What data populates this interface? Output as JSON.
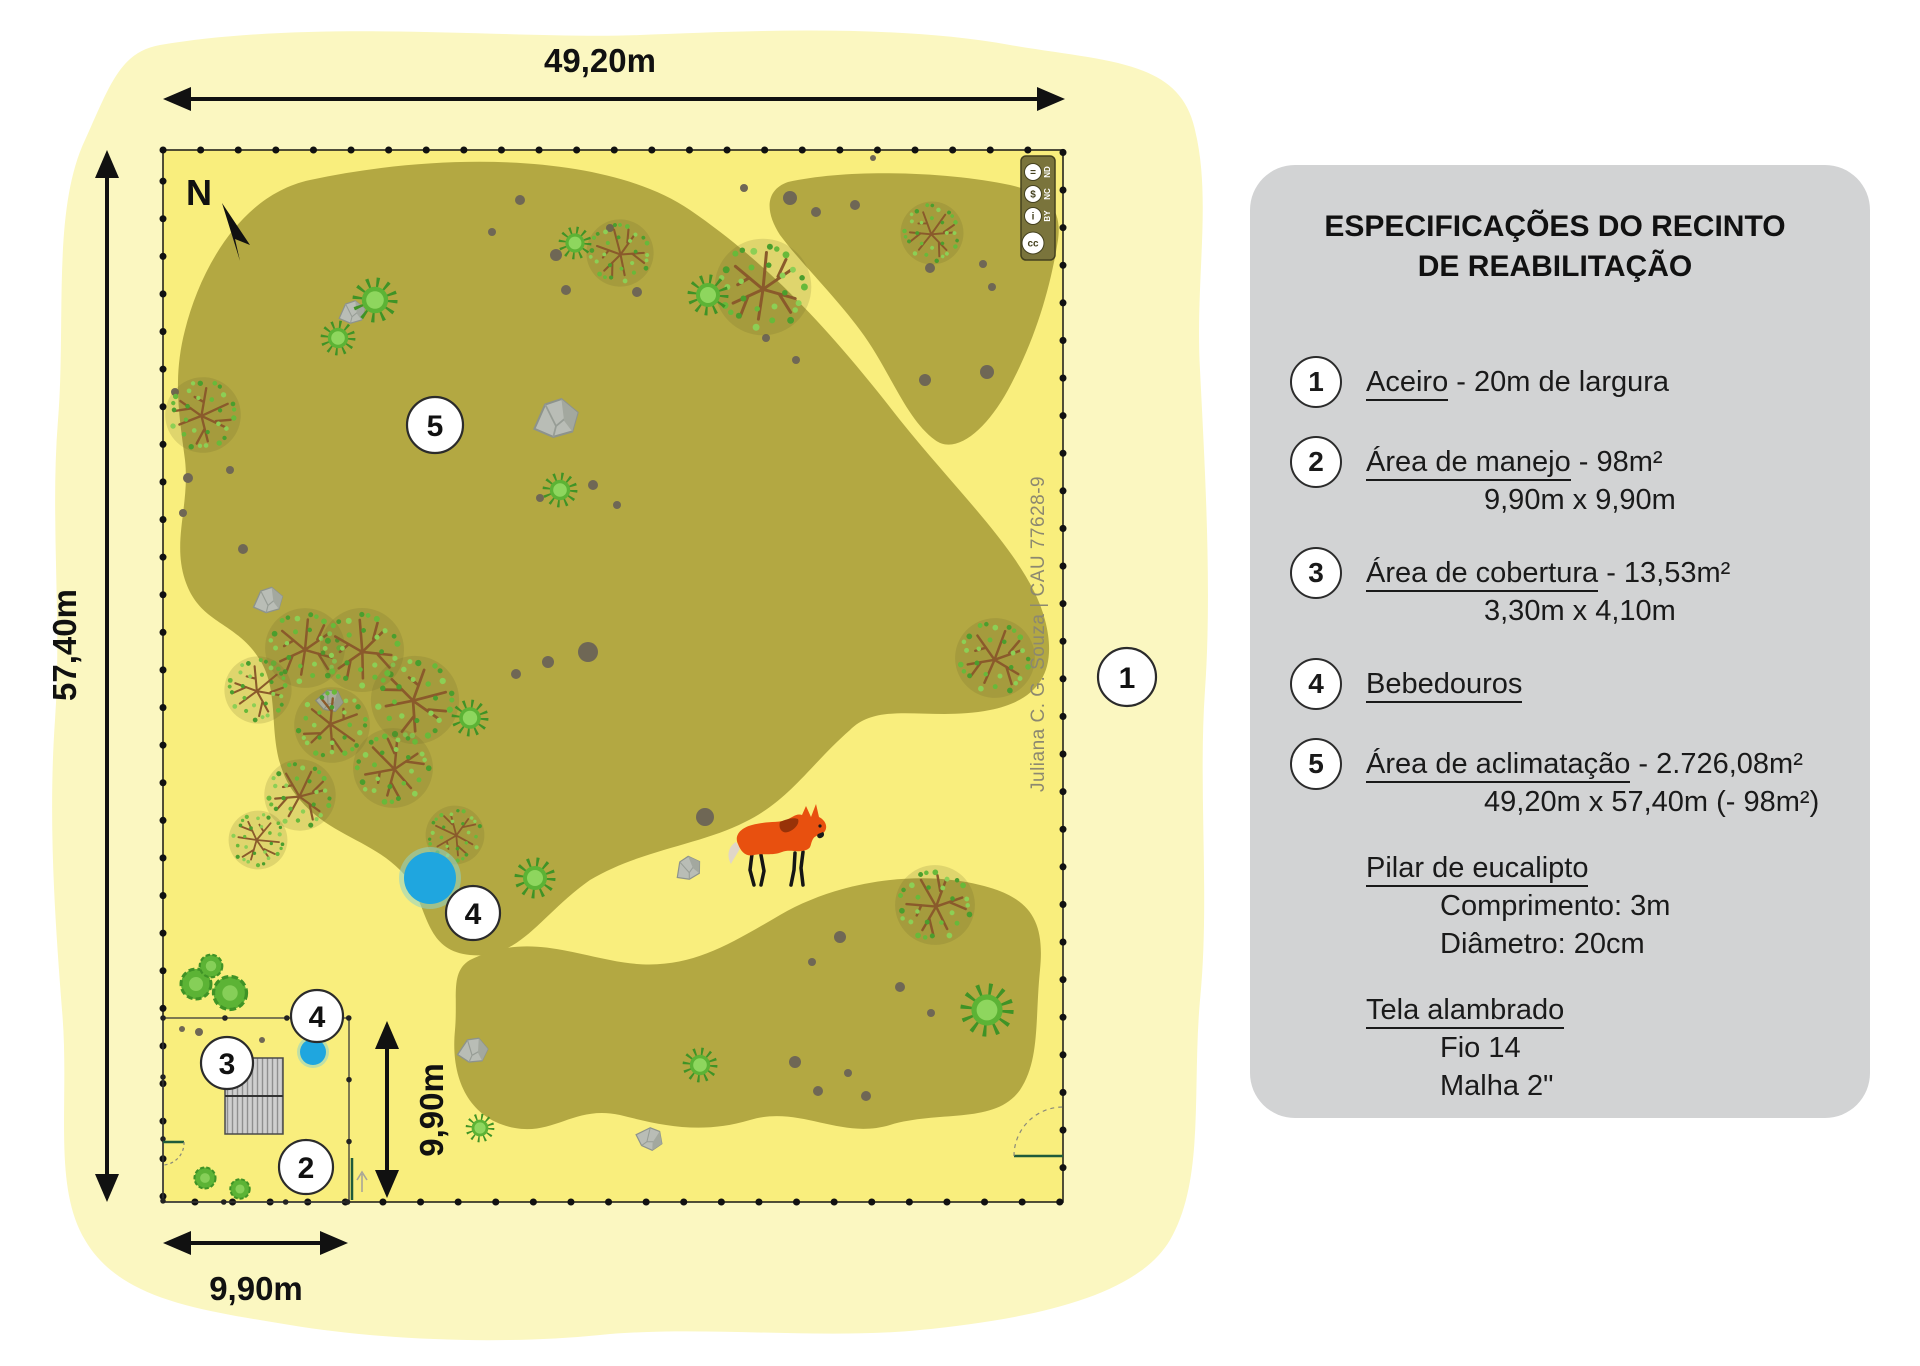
{
  "panel": {
    "title_line1": "ESPECIFICAÇÕES DO RECINTO",
    "title_line2": "DE REABILITAÇÃO",
    "items": [
      {
        "num": "1",
        "term": "Aceiro",
        "rest": " - 20m de largura",
        "sub1": ""
      },
      {
        "num": "2",
        "term": "Área de manejo",
        "rest": " - 98m²",
        "sub1": "9,90m x 9,90m"
      },
      {
        "num": "3",
        "term": "Área de cobertura",
        "rest": " - 13,53m²",
        "sub1": "3,30m x 4,10m"
      },
      {
        "num": "4",
        "term": "Bebedouros",
        "rest": "",
        "sub1": ""
      },
      {
        "num": "5",
        "term": "Área de aclimatação",
        "rest": " - 2.726,08m²",
        "sub1": "49,20m x 57,40m (- 98m²)"
      }
    ],
    "notes": [
      {
        "term": "Pilar de eucalipto",
        "sub1": "Comprimento: 3m",
        "sub2": "Diâmetro: 20cm"
      },
      {
        "term": "Tela alambrado",
        "sub1": "Fio 14",
        "sub2": "Malha 2\""
      }
    ]
  },
  "map": {
    "compass": "N",
    "dim_top": "49,20m",
    "dim_left": "57,40m",
    "dim_pen_width": "9,90m",
    "dim_pen_height": "9,90m",
    "credit": "Juliana C. G. Souza | CAU 77628-9",
    "license": {
      "cc": "cc",
      "by": "BY",
      "nc": "NC",
      "nd": "ND",
      "nd_glyph": "=",
      "nc_glyph": "$",
      "by_glyph": "i"
    },
    "markers": {
      "aceiro": "1",
      "manejo": "2",
      "cobertura": "3",
      "bebedouro_pen": "4",
      "bebedouro_pond": "4",
      "aclimatacao": "5"
    }
  },
  "colors": {
    "outer_field": "#fbf7c1",
    "enclosure_yellow": "#f9ee7d",
    "vegetation_olive": "#b3a842",
    "pond_blue": "#1fa6df",
    "panel_gray": "#d2d3d4",
    "wolf_orange": "#e8500f",
    "gate_green": "#1e5b3a"
  }
}
